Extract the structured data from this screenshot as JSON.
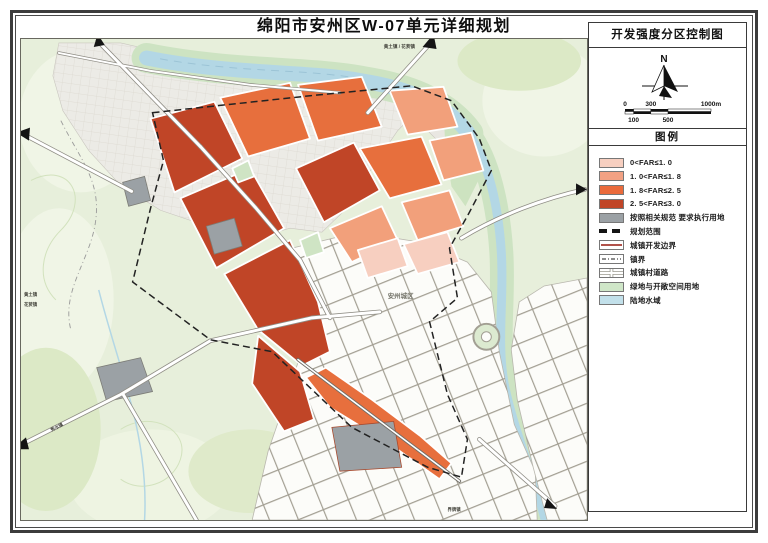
{
  "header": {
    "title": "绵阳市安州区W-07单元详细规划"
  },
  "panel": {
    "title": "开发强度分区控制图",
    "north_label": "N",
    "scale": {
      "t0": "0",
      "t1": "300",
      "t2": "1000m",
      "b0": "100",
      "b1": "500"
    },
    "legend_header": "图例",
    "legend": {
      "items": [
        {
          "label": "0<FAR≤1. 0",
          "color": "#f7cfc0"
        },
        {
          "label": "1. 0<FAR≤1. 8",
          "color": "#f2a183"
        },
        {
          "label": "1. 8<FAR≤2. 5",
          "color": "#ea6b3c"
        },
        {
          "label": "2. 5<FAR≤3. 0",
          "color": "#c04527"
        },
        {
          "label": "按照相关规范 要求执行用地",
          "color": "#9ba1a5"
        },
        {
          "label": "规划范围",
          "color": "#141414"
        },
        {
          "label": "城镇开发边界",
          "color": "#b1524a"
        },
        {
          "label": "镇界",
          "color": "#8c8c8c"
        },
        {
          "label": "城镇村道路",
          "color": "#9a988e"
        },
        {
          "label": "绿地与开敞空间用地",
          "color": "#cfe6c8"
        },
        {
          "label": "陆地水域",
          "color": "#c2e0ea"
        }
      ]
    }
  },
  "map": {
    "labels": [
      {
        "text": "安州城区"
      },
      {
        "text": "黄土镇 / 花荄镇"
      },
      {
        "text": "黄土镇"
      },
      {
        "text": "花荄镇"
      },
      {
        "text": "秀水镇"
      },
      {
        "text": "界牌镇"
      }
    ]
  },
  "colors": {
    "map_background": "#e7efdb",
    "water": "#b3d7e5",
    "green_buffer": "#cde3c2",
    "existing_town": "#ecebe6",
    "far_0_10": "#f7cfc0",
    "far_10_18": "#f2a183",
    "far_18_25": "#ea6b3c",
    "far_25_30": "#c04527",
    "regulated_gray": "#9ba1a5",
    "road_casing": "#8f8d85",
    "planning_boundary": "#222222"
  }
}
